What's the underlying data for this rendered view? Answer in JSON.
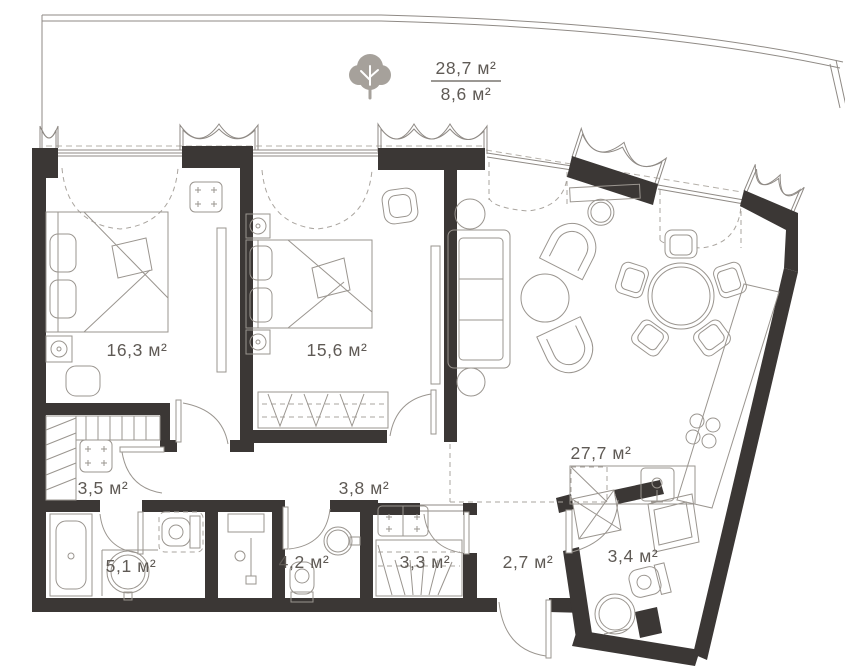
{
  "plan": {
    "terrace": {
      "area_total": "28,7 м²",
      "area_reduced": "8,6 м²",
      "tree_icon": "tree"
    },
    "rooms": [
      {
        "id": "bedroom-1",
        "label": "16,3 м²"
      },
      {
        "id": "bedroom-2",
        "label": "15,6 м²"
      },
      {
        "id": "wardrobe-hall",
        "label": "3,5 м²"
      },
      {
        "id": "bathroom-main",
        "label": "5,1 м²"
      },
      {
        "id": "bathroom-2",
        "label": "4,2 м²"
      },
      {
        "id": "hallway",
        "label": "3,8 м²"
      },
      {
        "id": "storage",
        "label": "3,3 м²"
      },
      {
        "id": "entry-hall",
        "label": "2,7 м²"
      },
      {
        "id": "bathroom-3",
        "label": "3,4 м²"
      },
      {
        "id": "kitchen-living",
        "label": "27,7 м²"
      }
    ],
    "colors": {
      "wall": "#3b3735",
      "line": "#8f8a85",
      "dashed": "#aaa59f",
      "text": "#5f5a55",
      "tree": "#a6a19b"
    }
  }
}
